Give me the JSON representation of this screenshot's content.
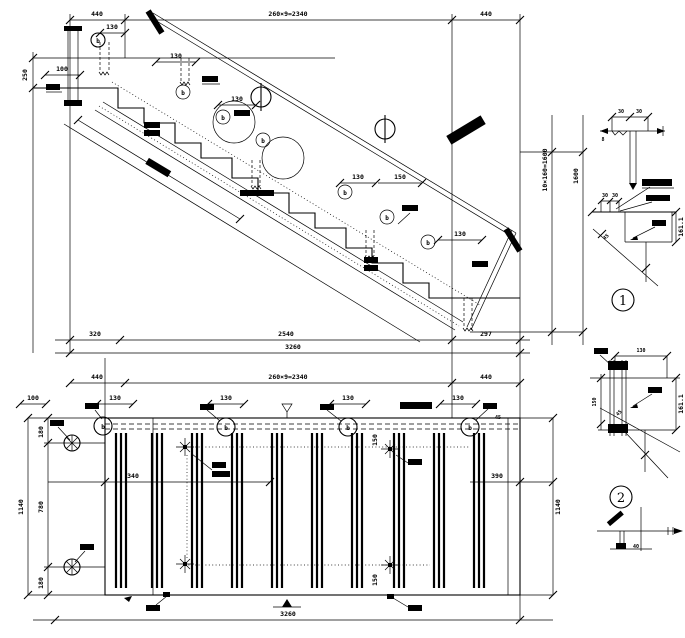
{
  "section": {
    "top_dims": {
      "left": "440",
      "mid": "260×9=2340",
      "right": "440"
    },
    "dim_130_top": "130",
    "dim_100": "100",
    "dim_250": "250",
    "step_dims": [
      "130",
      "130",
      "130",
      "150",
      "130"
    ],
    "height_dim": "10×160=1600",
    "height_total": "1600",
    "bottom_dims": {
      "d1": "320",
      "d2": "2540",
      "d3": "297",
      "total": "3260"
    },
    "marker_letter": "b"
  },
  "plan": {
    "top_dims": {
      "left": "440",
      "mid": "260×9=2340",
      "right": "440"
    },
    "dim_100": "100",
    "dim_130": "130",
    "left_dims": {
      "top": "180",
      "mid": "780",
      "bottom": "180",
      "total": "1140"
    },
    "right_dims": {
      "total": "1140",
      "d390": "390",
      "d45": "45"
    },
    "dim_340": "340",
    "dim_150": "150",
    "bottom_total": "3260",
    "marker_letter": "b"
  },
  "details": {
    "coping": {
      "dim_a": "30",
      "dim_b": "30",
      "dim_c": "8"
    },
    "d1": {
      "label": "1",
      "dim_a": "30",
      "dim_b": "30",
      "elev": "161.1",
      "angle": "45"
    },
    "d2": {
      "label": "2",
      "dim_top": "130",
      "dim_side": "150",
      "elev": "161.1",
      "angle": "45"
    },
    "corner": {
      "dim": "40"
    }
  }
}
